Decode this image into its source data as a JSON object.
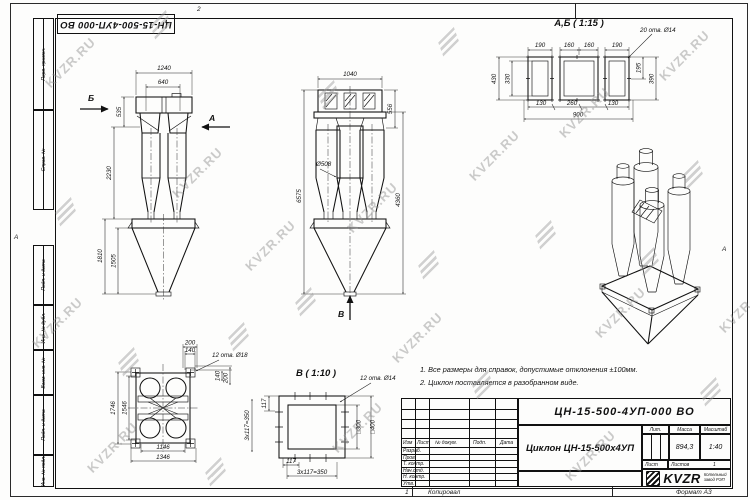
{
  "watermark": {
    "text": "KVZR.RU"
  },
  "frame": {
    "zone_top": "2",
    "zone_bottom": "1",
    "zone_right": "А",
    "zone_left": "А",
    "copied_label": "Копировал",
    "format_label": "Формат А3",
    "stamps": [
      "Перв. примен.",
      "Справ. №",
      "Подп. и дата",
      "Инв. № дубл.",
      "Взам. инв. №",
      "Подп. и дата",
      "Инв. № подл."
    ]
  },
  "designation_flipped": "ЦН-15-500-4УП-000 ВО",
  "notes": {
    "line1": "1. Все размеры для справок, допустимые отклонения ±100мм.",
    "line2": "2. Циклон поставляется в разобранном виде."
  },
  "views": {
    "front": {
      "label_b": "Б",
      "label_a": "А",
      "dim_1240": "1240",
      "dim_640": "640",
      "dim_535": "535",
      "dim_2230": "2230",
      "dim_1810": "1810",
      "dim_1505": "1505"
    },
    "side": {
      "dim_1040": "1040",
      "dim_556": "556",
      "dim_d508": "Ø508",
      "dim_6575": "6575",
      "dim_4360": "4360",
      "label_v": "В"
    },
    "ab": {
      "title": "А,Б ( 1:15 )",
      "holes": "20 отв. Ø14",
      "dim_190l": "190",
      "dim_160a": "160",
      "dim_160b": "160",
      "dim_190r": "190",
      "dim_430": "430",
      "dim_330": "330",
      "dim_195": "195",
      "dim_390": "390",
      "dim_130l": "130",
      "dim_260": "260",
      "dim_130r": "130",
      "dim_900": "900"
    },
    "plan": {
      "dim_200t": "200",
      "dim_140t": "140",
      "holes": "12 отв. Ø18",
      "dim_140r": "140",
      "dim_200r": "200",
      "dim_1746": "1746",
      "dim_1546": "1546",
      "dim_1146": "1146",
      "dim_1346": "1346"
    },
    "v": {
      "title": "В ( 1:10 )",
      "holes": "12 отв. Ø14",
      "dim_117l": "117",
      "dim_350l": "3х117=350",
      "dim_sq300": "□300",
      "dim_sq400": "□400",
      "dim_117b": "117",
      "dim_350b": "3х117=350"
    }
  },
  "titleblock": {
    "designation": "ЦН-15-500-4УП-000 ВО",
    "name": "Циклон ЦН-15-500х4УП",
    "col_izm": "Изм",
    "col_list": "Лист",
    "col_doc": "№ докум.",
    "col_podp": "Подп.",
    "col_data": "Дата",
    "rows": [
      "Разраб.",
      "Пров.",
      "Т. контр.",
      "Нач.отд.",
      "Н. контр.",
      "Утв."
    ],
    "lit_label": "Лит.",
    "mass_label": "Масса",
    "scale_label": "Масштаб",
    "mass": "894,3",
    "scale": "1:40",
    "sheet_label": "Лист",
    "sheets_label": "Листов",
    "sheets_value": "1",
    "company_logo": "KVZR",
    "company_line1": "Котельный",
    "company_line2": "завод РЭП"
  }
}
